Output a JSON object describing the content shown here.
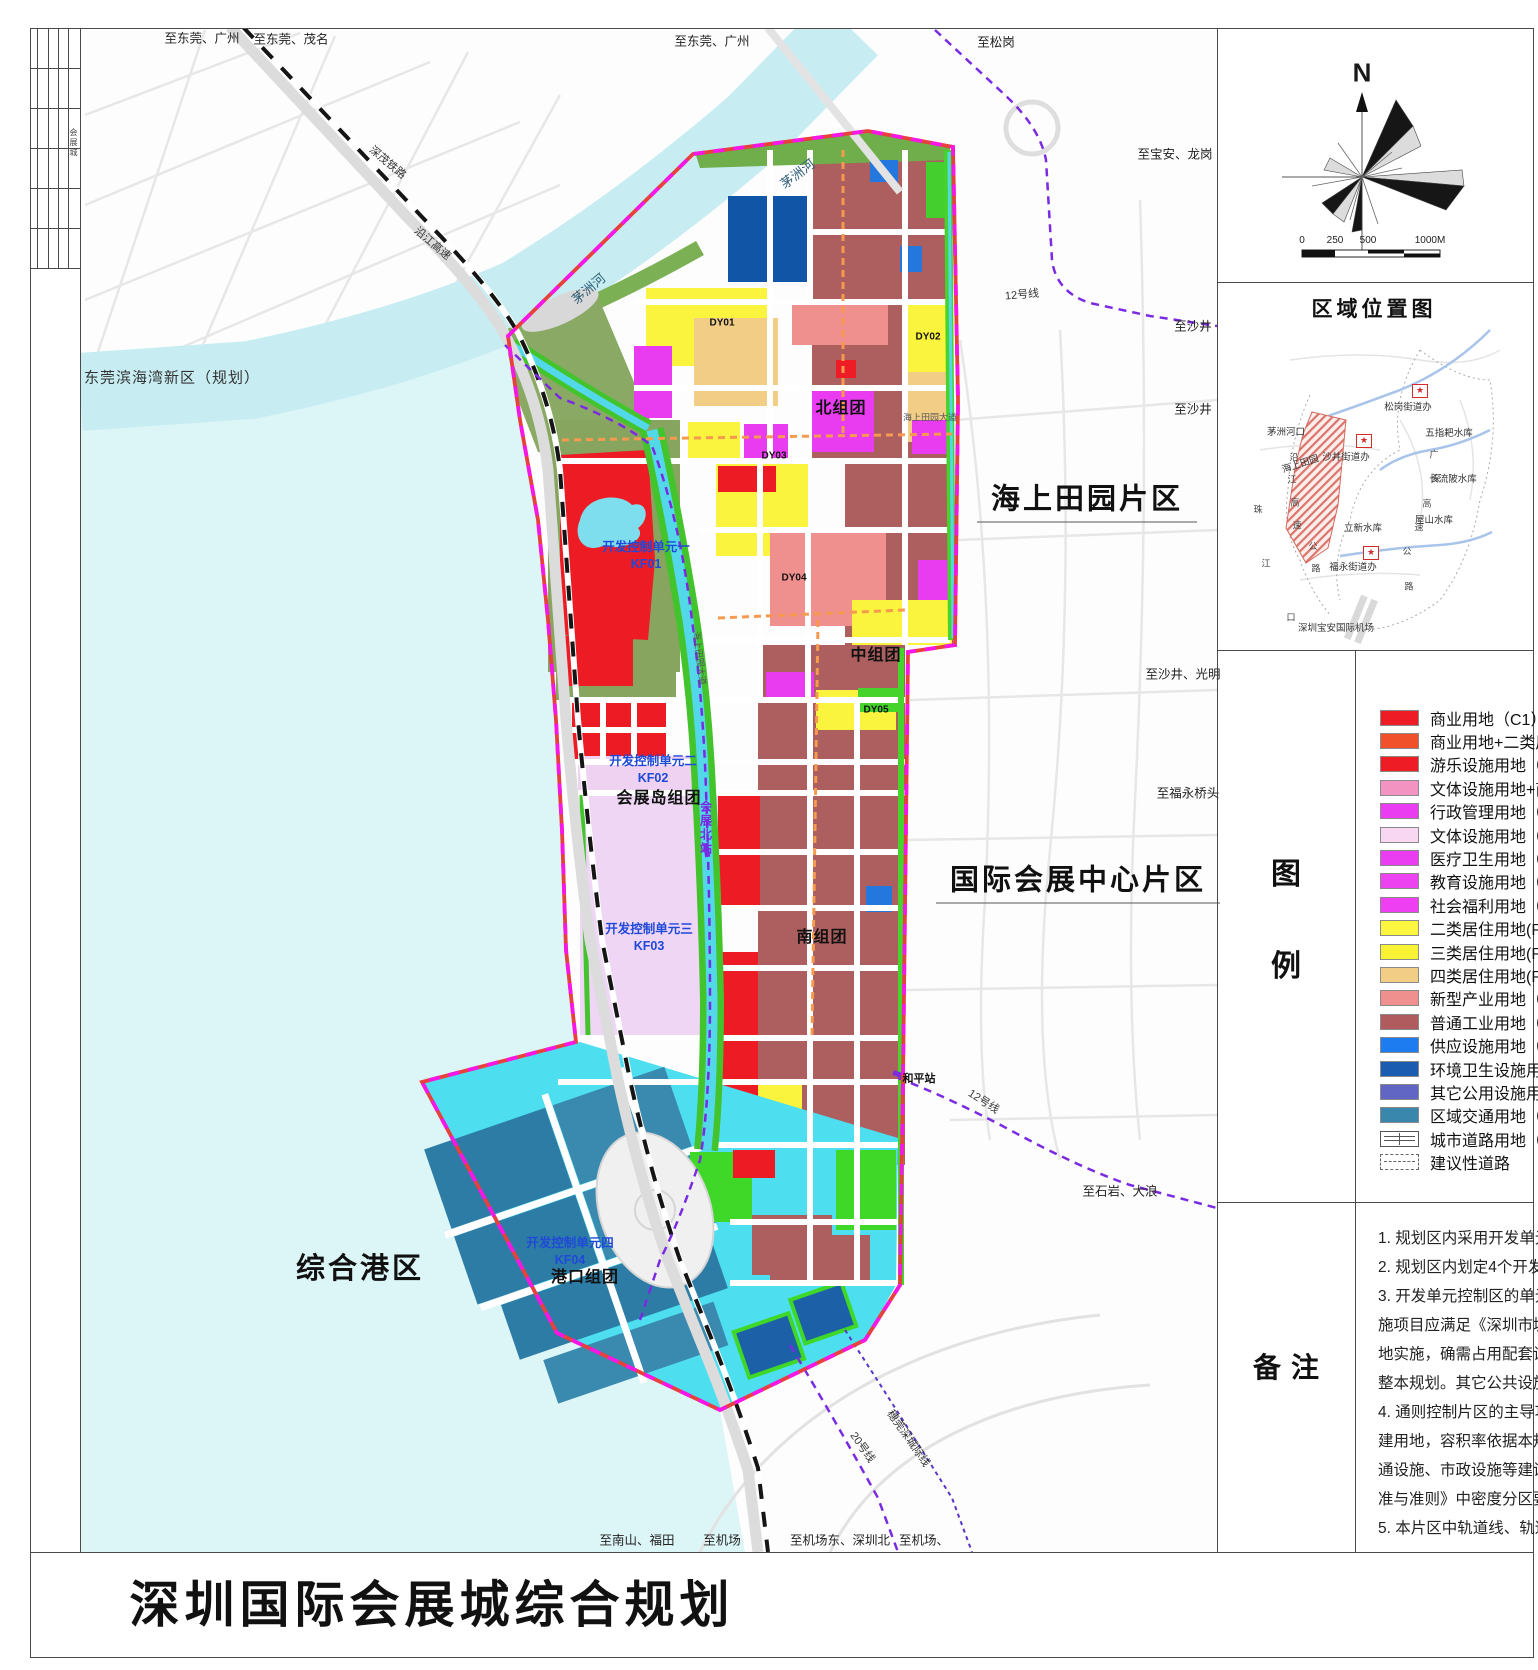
{
  "sheet": {
    "title": "深圳国际会展城综合规划",
    "title_block_side_text": "会展城"
  },
  "compass": {
    "north_label": "N",
    "scale_ticks": [
      "0",
      "250",
      "500",
      "1000M"
    ]
  },
  "location_map": {
    "title": "区域位置图",
    "labels": [
      {
        "t": "松岗街道办",
        "x": 1408,
        "y": 406
      },
      {
        "t": "五指耙水库",
        "x": 1449,
        "y": 432
      },
      {
        "t": "茅洲河口",
        "x": 1286,
        "y": 431
      },
      {
        "t": "沙井街道办",
        "x": 1346,
        "y": 456
      },
      {
        "t": "海上田园",
        "x": 1300,
        "y": 463,
        "r": -18
      },
      {
        "t": "长流陂水库",
        "x": 1453,
        "y": 478
      },
      {
        "t": "屋山水库",
        "x": 1434,
        "y": 519
      },
      {
        "t": "立新水库",
        "x": 1363,
        "y": 527
      },
      {
        "t": "福永街道办",
        "x": 1353,
        "y": 566
      },
      {
        "t": "深圳宝安国际机场",
        "x": 1336,
        "y": 627
      },
      {
        "t": "珠",
        "x": 1258,
        "y": 509,
        "c": "v1"
      },
      {
        "t": "江",
        "x": 1266,
        "y": 563,
        "c": "v1"
      },
      {
        "t": "口",
        "x": 1291,
        "y": 617,
        "c": "v1"
      },
      {
        "t": "沿",
        "x": 1294,
        "y": 457,
        "c": "v1"
      },
      {
        "t": "江",
        "x": 1292,
        "y": 479,
        "c": "v1"
      },
      {
        "t": "高",
        "x": 1295,
        "y": 502,
        "c": "v1"
      },
      {
        "t": "速",
        "x": 1297,
        "y": 525,
        "c": "v1"
      },
      {
        "t": "公",
        "x": 1313,
        "y": 546,
        "c": "v1"
      },
      {
        "t": "路",
        "x": 1316,
        "y": 568,
        "c": "v1"
      },
      {
        "t": "广",
        "x": 1434,
        "y": 454,
        "c": "v1"
      },
      {
        "t": "深",
        "x": 1436,
        "y": 478,
        "c": "v1"
      },
      {
        "t": "高",
        "x": 1427,
        "y": 503,
        "c": "v1"
      },
      {
        "t": "速",
        "x": 1419,
        "y": 527,
        "c": "v1"
      },
      {
        "t": "公",
        "x": 1407,
        "y": 551,
        "c": "v1"
      },
      {
        "t": "路",
        "x": 1409,
        "y": 586,
        "c": "v1"
      }
    ],
    "stars": [
      {
        "x": 1420,
        "y": 391
      },
      {
        "x": 1364,
        "y": 441
      },
      {
        "x": 1371,
        "y": 553
      }
    ],
    "star_glyph": "★"
  },
  "legend": {
    "label": "图例",
    "items": [
      {
        "label": "商业用地（C1）",
        "color": "#ee1c25"
      },
      {
        "label": "商业用地+二类居住用地（C1+R2）",
        "color": "#f0512b"
      },
      {
        "label": "游乐设施用地（C5）",
        "color": "#ee1c25"
      },
      {
        "label": "文体设施用地+商业用地（GIC2+C1）",
        "color": "#f393c2"
      },
      {
        "label": "行政管理用地（GIC1）",
        "color": "#ea3df2"
      },
      {
        "label": "文体设施用地（GIC2）",
        "color": "#f8d7f3"
      },
      {
        "label": "医疗卫生用地（GIC4）",
        "color": "#ea3df2"
      },
      {
        "label": "教育设施用地（GIC5）",
        "color": "#ec42f0"
      },
      {
        "label": "社会福利用地（GIC7）",
        "color": "#ee3ff2"
      },
      {
        "label": "二类居住用地(R2)",
        "color": "#fcf63e"
      },
      {
        "label": "三类居住用地(R3)",
        "color": "#f7f233"
      },
      {
        "label": "四类居住用地(R4)",
        "color": "#f2cd85"
      },
      {
        "label": "新型产业用地（M0）",
        "color": "#f0908e"
      },
      {
        "label": "普通工业用地（M1）",
        "color": "#b05c5e"
      },
      {
        "label": "供应设施用地（U1）",
        "color": "#1d7cf0"
      },
      {
        "label": "环境卫生设施用地（U3）",
        "color": "#1c5cb0"
      },
      {
        "label": "其它公用设施用地（U9）",
        "color": "#6166c4"
      },
      {
        "label": "区域交通用地（S1）",
        "color": "#3a87ad"
      },
      {
        "label": "城市道路用地（S2）",
        "sym": "road"
      },
      {
        "label": "建议性道路",
        "sym": "sug"
      }
    ]
  },
  "notes": {
    "label": "备注",
    "lines": [
      "1. 规划区内采用开发单元控制与通则控制两种方式。",
      "2. 规划区内划定4个开发单元控制区。",
      "3. 开发单元控制区的单元内公共配套设",
      "施项目应满足《深圳市城市规划标准与准则》要求，落",
      "地实施，确需占用配套设施用地的，应调",
      "整本规划。其它公共设施可结合开发建设实施。",
      "4. 通则控制片区的主导功能为现状保留及改",
      "建用地，容积率依据本规划确定；公共服务设施、交",
      "通设施、市政设施等建设标准按照《深圳市城市规划标",
      "准与准则》中密度分区要求执行。",
      "5. 本片区中轨道线、轨道站点位置以最终批复为准。"
    ]
  },
  "map": {
    "labels": [
      {
        "t": "至东莞、广州",
        "x": 202,
        "y": 37,
        "c": "e"
      },
      {
        "t": "至东莞、茂名",
        "x": 291,
        "y": 38,
        "c": "e"
      },
      {
        "t": "至东莞、广州",
        "x": 712,
        "y": 40,
        "c": "e"
      },
      {
        "t": "至松岗",
        "x": 996,
        "y": 41,
        "c": "e"
      },
      {
        "t": "至宝安、龙岗",
        "x": 1175,
        "y": 153,
        "c": "e"
      },
      {
        "t": "至沙井",
        "x": 1193,
        "y": 325,
        "c": "e"
      },
      {
        "t": "至沙井",
        "x": 1193,
        "y": 408,
        "c": "e"
      },
      {
        "t": "至沙井、光明",
        "x": 1183,
        "y": 673,
        "c": "e"
      },
      {
        "t": "至福永桥头",
        "x": 1188,
        "y": 792,
        "c": "e"
      },
      {
        "t": "至石岩、大浪",
        "x": 1120,
        "y": 1190,
        "c": "e"
      },
      {
        "t": "至南山、福田",
        "x": 637,
        "y": 1539,
        "c": "e"
      },
      {
        "t": "至机场",
        "x": 722,
        "y": 1539,
        "c": "e"
      },
      {
        "t": "至机场东、深圳北",
        "x": 840,
        "y": 1539,
        "c": "e"
      },
      {
        "t": "至机场、",
        "x": 924,
        "y": 1539,
        "c": "e"
      },
      {
        "t": "深茂铁路",
        "x": 388,
        "y": 162,
        "c": "r",
        "r": 40
      },
      {
        "t": "沿江高速",
        "x": 433,
        "y": 243,
        "c": "r",
        "r": 40
      },
      {
        "t": "茅洲河",
        "x": 797,
        "y": 173,
        "c": "rl",
        "r": -37
      },
      {
        "t": "茅洲河",
        "x": 588,
        "y": 288,
        "c": "rl",
        "r": -40
      },
      {
        "t": "12号线",
        "x": 1022,
        "y": 294,
        "c": "r",
        "r": -5
      },
      {
        "t": "12号线",
        "x": 984,
        "y": 1101,
        "c": "r",
        "r": 33
      },
      {
        "t": "20号线",
        "x": 863,
        "y": 1447,
        "c": "r",
        "r": 55
      },
      {
        "t": "穗莞深城际线",
        "x": 909,
        "y": 1438,
        "c": "r",
        "r": 55
      },
      {
        "t": "海上田园大道",
        "x": 930,
        "y": 417,
        "c": "tiny"
      },
      {
        "t": "海上田园大道",
        "x": 700,
        "y": 658,
        "c": "tiny",
        "r": 83
      },
      {
        "t": "东莞滨海湾新区（规划）",
        "x": 172,
        "y": 377,
        "c": "area"
      },
      {
        "t": "海上田园片区",
        "x": 1087,
        "y": 499,
        "c": "bigu"
      },
      {
        "t": "国际会展中心片区",
        "x": 1078,
        "y": 880,
        "c": "bigu"
      },
      {
        "t": "综合港区",
        "x": 360,
        "y": 1266,
        "c": "big"
      },
      {
        "t": "北组团",
        "x": 841,
        "y": 406,
        "c": "g"
      },
      {
        "t": "中组团",
        "x": 876,
        "y": 653,
        "c": "g"
      },
      {
        "t": "南组团",
        "x": 822,
        "y": 935,
        "c": "g"
      },
      {
        "t": "会展岛组团",
        "x": 659,
        "y": 796,
        "c": "g"
      },
      {
        "t": "港口组团",
        "x": 585,
        "y": 1275,
        "c": "g"
      },
      {
        "t": "开发控制单元一\nKF01",
        "x": 646,
        "y": 556,
        "c": "kf"
      },
      {
        "t": "开发控制单元二\nKF02",
        "x": 653,
        "y": 770,
        "c": "kf"
      },
      {
        "t": "开发控制单元三\nKF03",
        "x": 649,
        "y": 938,
        "c": "kf"
      },
      {
        "t": "开发控制单元四\nKF04",
        "x": 570,
        "y": 1252,
        "c": "kf"
      },
      {
        "t": "DY01",
        "x": 722,
        "y": 323,
        "c": "dy"
      },
      {
        "t": "DY02",
        "x": 928,
        "y": 337,
        "c": "dy"
      },
      {
        "t": "DY03",
        "x": 774,
        "y": 456,
        "c": "dy"
      },
      {
        "t": "DY04",
        "x": 794,
        "y": 578,
        "c": "dy"
      },
      {
        "t": "DY05",
        "x": 876,
        "y": 710,
        "c": "dy"
      },
      {
        "t": "和平站",
        "x": 919,
        "y": 1078,
        "c": "st"
      },
      {
        "t": "会展北站",
        "x": 706,
        "y": 828,
        "c": "v"
      }
    ]
  }
}
